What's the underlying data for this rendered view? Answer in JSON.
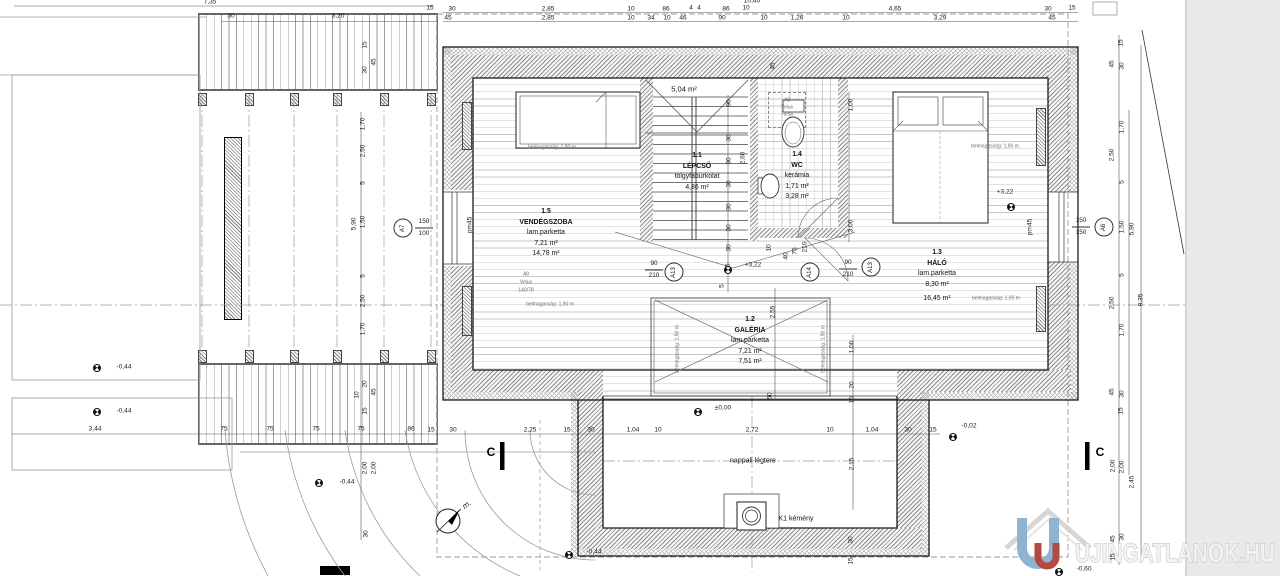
{
  "rooms": [
    {
      "id": "1.5",
      "name": "VENDÉGSZOBA",
      "material": "lam.parketta",
      "area1": "7,21 m²",
      "area2": "14,78 m²"
    },
    {
      "id": "1.1",
      "name": "LÉPCSŐ",
      "material": "tölgyfaburkolat",
      "area1": "4,86 m²",
      "area2": ""
    },
    {
      "id": "1.4",
      "name": "WC",
      "material": "kerámia",
      "area1": "1,71 m²",
      "area2": "3,28 m²"
    },
    {
      "id": "1.3",
      "name": "HÁLÓ",
      "material": "lam.parketta",
      "area1": "8,30 m²",
      "area2": "16,45 m²"
    },
    {
      "id": "1.2",
      "name": "GALÉRIA",
      "material": "lam.parketta",
      "area1": "7,21 m²",
      "area2": "7,51 m²"
    }
  ],
  "watermark": {
    "text": "UJINGATLANOK.HU"
  },
  "texts": [
    {
      "t": "5,04 m²",
      "x": 684,
      "y": 89,
      "cls": "area",
      "n": "roof-area-label"
    },
    {
      "t": "belmagasság: 1,90 m",
      "x": 552,
      "y": 148,
      "cls": "bm",
      "n": "headroom-label"
    },
    {
      "t": "belmagasság: 1,90 m",
      "x": 550,
      "y": 305,
      "cls": "bm",
      "n": "headroom-label"
    },
    {
      "t": "belmagasság: 1,90 m",
      "x": 995,
      "y": 147,
      "cls": "bm",
      "n": "headroom-label"
    },
    {
      "t": "belmagasság: 1,90 m",
      "x": 996,
      "y": 299,
      "cls": "bm",
      "n": "headroom-label"
    },
    {
      "t": "belmagasság: 1,90 m",
      "x": 678,
      "y": 349,
      "r": -90,
      "cls": "bm",
      "n": "headroom-label"
    },
    {
      "t": "belmagasság: 1,90 m",
      "x": 824,
      "y": 349,
      "r": -90,
      "cls": "bm",
      "n": "headroom-label"
    },
    {
      "t": "A8",
      "x": 787,
      "y": 101,
      "cls": "bm",
      "n": "velux-label"
    },
    {
      "t": "Velux",
      "x": 787,
      "y": 108,
      "cls": "bm",
      "n": "velux-label"
    },
    {
      "t": "78/55",
      "x": 787,
      "y": 115,
      "cls": "bm",
      "n": "velux-label"
    },
    {
      "t": "A8",
      "x": 526,
      "y": 275,
      "cls": "bm",
      "n": "velux-label"
    },
    {
      "t": "Velux",
      "x": 526,
      "y": 283,
      "cls": "bm",
      "n": "velux-label"
    },
    {
      "t": "140/78",
      "x": 526,
      "y": 291,
      "cls": "bm",
      "n": "velux-label"
    },
    {
      "t": "pm45",
      "x": 471,
      "y": 225,
      "r": -90,
      "cls": "dim",
      "n": "parapet-label"
    },
    {
      "t": "pm45",
      "x": 1031,
      "y": 227,
      "r": -90,
      "cls": "dim",
      "n": "parapet-label"
    },
    {
      "t": "nappali légtere",
      "x": 753,
      "y": 461,
      "cls": "lbl",
      "n": "living-void-label"
    },
    {
      "t": "K1 kémény",
      "x": 796,
      "y": 519,
      "cls": "lbl",
      "n": "chimney-label"
    },
    {
      "t": "m.",
      "x": 467,
      "y": 505,
      "r": -38,
      "cls": "north",
      "n": "north-label"
    },
    {
      "t": "C",
      "x": 491,
      "y": 452,
      "cls": "section",
      "n": "section-letter"
    },
    {
      "t": "C",
      "x": 1100,
      "y": 452,
      "cls": "section",
      "n": "section-letter"
    }
  ],
  "levels": [
    {
      "t": "-0,44",
      "tx": 124,
      "ty": 368,
      "mx": 97,
      "my": 368
    },
    {
      "t": "-0,44",
      "tx": 124,
      "ty": 412,
      "mx": 97,
      "my": 412
    },
    {
      "t": "-0,44",
      "tx": 347,
      "ty": 483,
      "mx": 319,
      "my": 483
    },
    {
      "t": "±0,00",
      "tx": 723,
      "ty": 409,
      "mx": 698,
      "my": 412
    },
    {
      "t": "+3,22",
      "tx": 753,
      "ty": 266,
      "mx": 728,
      "my": 270
    },
    {
      "t": "+3,22",
      "tx": 1005,
      "ty": 193,
      "mx": 1011,
      "my": 207
    },
    {
      "t": "-0,02",
      "tx": 969,
      "ty": 427,
      "mx": 953,
      "my": 437
    },
    {
      "t": "-0,44",
      "tx": 594,
      "ty": 553,
      "mx": 569,
      "my": 555
    },
    {
      "t": "-0,60",
      "tx": 1084,
      "ty": 570,
      "mx": 1059,
      "my": 572
    }
  ],
  "marks": [
    {
      "label": "A7",
      "cx": 403,
      "cy": 228,
      "sizes": [
        "150",
        "100"
      ],
      "sx": 424,
      "sy": 228
    },
    {
      "label": "A6",
      "cx": 1104,
      "cy": 227,
      "sizes": [
        "150",
        "150"
      ],
      "sx": 1081,
      "sy": 227
    },
    {
      "label": "A13",
      "cx": 674,
      "cy": 272,
      "sizes": [
        "90",
        "210"
      ],
      "sx": 654,
      "sy": 270
    },
    {
      "label": "A14",
      "cx": 810,
      "cy": 272,
      "sizes": [],
      "sx": 0,
      "sy": 0
    },
    {
      "label": "A13",
      "cx": 871,
      "cy": 267,
      "sizes": [
        "90",
        "210"
      ],
      "sx": 848,
      "sy": 269
    }
  ],
  "dims": [
    {
      "t": "7,35",
      "x": 210,
      "y": 3
    },
    {
      "t": "30",
      "x": 231,
      "y": 17
    },
    {
      "t": "3,20",
      "x": 338,
      "y": 17
    },
    {
      "t": "15",
      "x": 430,
      "y": 9
    },
    {
      "t": "15",
      "x": 366,
      "y": 45,
      "r": -90
    },
    {
      "t": "30",
      "x": 366,
      "y": 70,
      "r": -90
    },
    {
      "t": "45",
      "x": 375,
      "y": 62,
      "r": -90
    },
    {
      "t": "45",
      "x": 448,
      "y": 19
    },
    {
      "t": "30",
      "x": 452,
      "y": 10
    },
    {
      "t": "2,85",
      "x": 548,
      "y": 10
    },
    {
      "t": "2,85",
      "x": 548,
      "y": 19
    },
    {
      "t": "10",
      "x": 631,
      "y": 10
    },
    {
      "t": "10",
      "x": 631,
      "y": 19
    },
    {
      "t": "34",
      "x": 651,
      "y": 19
    },
    {
      "t": "86",
      "x": 666,
      "y": 10
    },
    {
      "t": "10",
      "x": 667,
      "y": 19
    },
    {
      "t": "4",
      "x": 691,
      "y": 9
    },
    {
      "t": "4",
      "x": 699,
      "y": 9
    },
    {
      "t": "46",
      "x": 683,
      "y": 19
    },
    {
      "t": "86",
      "x": 726,
      "y": 10
    },
    {
      "t": "90",
      "x": 722,
      "y": 19
    },
    {
      "t": "10",
      "x": 746,
      "y": 9
    },
    {
      "t": "10,40",
      "x": 752,
      "y": 2
    },
    {
      "t": "10",
      "x": 764,
      "y": 19
    },
    {
      "t": "1,26",
      "x": 797,
      "y": 19
    },
    {
      "t": "10",
      "x": 846,
      "y": 19
    },
    {
      "t": "4,65",
      "x": 895,
      "y": 10
    },
    {
      "t": "3,29",
      "x": 940,
      "y": 19
    },
    {
      "t": "30",
      "x": 1048,
      "y": 10
    },
    {
      "t": "45",
      "x": 1052,
      "y": 19
    },
    {
      "t": "15",
      "x": 1072,
      "y": 9
    },
    {
      "t": "45",
      "x": 774,
      "y": 66,
      "r": -90
    },
    {
      "t": "1,70",
      "x": 364,
      "y": 124,
      "r": -90
    },
    {
      "t": "2,50",
      "x": 364,
      "y": 151,
      "r": -90
    },
    {
      "t": "5",
      "x": 364,
      "y": 183,
      "r": -90
    },
    {
      "t": "1,50",
      "x": 364,
      "y": 222,
      "r": -90
    },
    {
      "t": "5,90",
      "x": 355,
      "y": 224,
      "r": -90
    },
    {
      "t": "5",
      "x": 364,
      "y": 276,
      "r": -90
    },
    {
      "t": "2,50",
      "x": 364,
      "y": 301,
      "r": -90
    },
    {
      "t": "1,70",
      "x": 364,
      "y": 329,
      "r": -90
    },
    {
      "t": "10",
      "x": 358,
      "y": 395,
      "r": -90
    },
    {
      "t": "20",
      "x": 366,
      "y": 384,
      "r": -90
    },
    {
      "t": "45",
      "x": 375,
      "y": 392,
      "r": -90
    },
    {
      "t": "15",
      "x": 366,
      "y": 411,
      "r": -90
    },
    {
      "t": "2,00",
      "x": 366,
      "y": 468,
      "r": -90
    },
    {
      "t": "2,00",
      "x": 375,
      "y": 468,
      "r": -90
    },
    {
      "t": "30",
      "x": 367,
      "y": 534,
      "r": -90
    },
    {
      "t": "3,44",
      "x": 95,
      "y": 430
    },
    {
      "t": "75",
      "x": 224,
      "y": 430
    },
    {
      "t": "75",
      "x": 270,
      "y": 430
    },
    {
      "t": "75",
      "x": 316,
      "y": 430
    },
    {
      "t": "75",
      "x": 361,
      "y": 430
    },
    {
      "t": "86",
      "x": 411,
      "y": 430
    },
    {
      "t": "15",
      "x": 431,
      "y": 431
    },
    {
      "t": "30",
      "x": 453,
      "y": 431
    },
    {
      "t": "2,25",
      "x": 530,
      "y": 431
    },
    {
      "t": "15",
      "x": 567,
      "y": 431
    },
    {
      "t": "30",
      "x": 591,
      "y": 431
    },
    {
      "t": "1,04",
      "x": 633,
      "y": 431
    },
    {
      "t": "10",
      "x": 658,
      "y": 431
    },
    {
      "t": "2,72",
      "x": 752,
      "y": 431
    },
    {
      "t": "10",
      "x": 830,
      "y": 431
    },
    {
      "t": "1,04",
      "x": 872,
      "y": 431
    },
    {
      "t": "30",
      "x": 908,
      "y": 431
    },
    {
      "t": "15",
      "x": 933,
      "y": 431
    },
    {
      "t": "15",
      "x": 1122,
      "y": 43,
      "r": -90
    },
    {
      "t": "45",
      "x": 1113,
      "y": 64,
      "r": -90
    },
    {
      "t": "30",
      "x": 1123,
      "y": 66,
      "r": -90
    },
    {
      "t": "1,70",
      "x": 1123,
      "y": 127,
      "r": -90
    },
    {
      "t": "2,50",
      "x": 1113,
      "y": 155,
      "r": -90
    },
    {
      "t": "5",
      "x": 1123,
      "y": 182,
      "r": -90
    },
    {
      "t": "1,50",
      "x": 1123,
      "y": 227,
      "r": -90
    },
    {
      "t": "5,90",
      "x": 1133,
      "y": 229,
      "r": -90
    },
    {
      "t": "5",
      "x": 1123,
      "y": 275,
      "r": -90
    },
    {
      "t": "2,50",
      "x": 1113,
      "y": 303,
      "r": -90
    },
    {
      "t": "8,35",
      "x": 1142,
      "y": 300,
      "r": -90
    },
    {
      "t": "1,70",
      "x": 1123,
      "y": 330,
      "r": -90
    },
    {
      "t": "45",
      "x": 1113,
      "y": 392,
      "r": -90
    },
    {
      "t": "30",
      "x": 1123,
      "y": 394,
      "r": -90
    },
    {
      "t": "15",
      "x": 1122,
      "y": 411,
      "r": -90
    },
    {
      "t": "2,00",
      "x": 1114,
      "y": 466,
      "r": -90
    },
    {
      "t": "2,00",
      "x": 1123,
      "y": 467,
      "r": -90
    },
    {
      "t": "2,45",
      "x": 1133,
      "y": 482,
      "r": -90
    },
    {
      "t": "45",
      "x": 1114,
      "y": 539,
      "r": -90
    },
    {
      "t": "30",
      "x": 1123,
      "y": 537,
      "r": -90
    },
    {
      "t": "15",
      "x": 1114,
      "y": 557,
      "r": -90
    },
    {
      "t": "1,00",
      "x": 852,
      "y": 105,
      "r": -90
    },
    {
      "t": "3,00",
      "x": 852,
      "y": 226,
      "r": -90
    },
    {
      "t": "90",
      "x": 730,
      "y": 103,
      "r": -90
    },
    {
      "t": "30",
      "x": 730,
      "y": 138,
      "r": -90
    },
    {
      "t": "30",
      "x": 730,
      "y": 161,
      "r": -90
    },
    {
      "t": "30",
      "x": 730,
      "y": 184,
      "r": -90
    },
    {
      "t": "30",
      "x": 730,
      "y": 207,
      "r": -90
    },
    {
      "t": "30",
      "x": 730,
      "y": 228,
      "r": -90
    },
    {
      "t": "30",
      "x": 730,
      "y": 248,
      "r": -90
    },
    {
      "t": "25",
      "x": 729,
      "y": 267,
      "r": -90
    },
    {
      "t": "5",
      "x": 723,
      "y": 286,
      "r": -90
    },
    {
      "t": "2,60",
      "x": 744,
      "y": 158,
      "r": -90
    },
    {
      "t": "10",
      "x": 770,
      "y": 248,
      "r": -90
    },
    {
      "t": "40",
      "x": 787,
      "y": 256,
      "r": -90
    },
    {
      "t": "75",
      "x": 796,
      "y": 251,
      "r": -90
    },
    {
      "t": "210",
      "x": 806,
      "y": 247,
      "r": -90
    },
    {
      "t": "2,55",
      "x": 774,
      "y": 312,
      "r": -90
    },
    {
      "t": "1,00",
      "x": 853,
      "y": 347,
      "r": -90
    },
    {
      "t": "20",
      "x": 853,
      "y": 385,
      "r": -90
    },
    {
      "t": "10",
      "x": 853,
      "y": 400,
      "r": -90
    },
    {
      "t": "50",
      "x": 771,
      "y": 396,
      "r": -90
    },
    {
      "t": "2,15",
      "x": 853,
      "y": 464,
      "r": -90
    },
    {
      "t": "30",
      "x": 852,
      "y": 540,
      "r": -90
    },
    {
      "t": "15",
      "x": 852,
      "y": 561,
      "r": -90
    }
  ]
}
